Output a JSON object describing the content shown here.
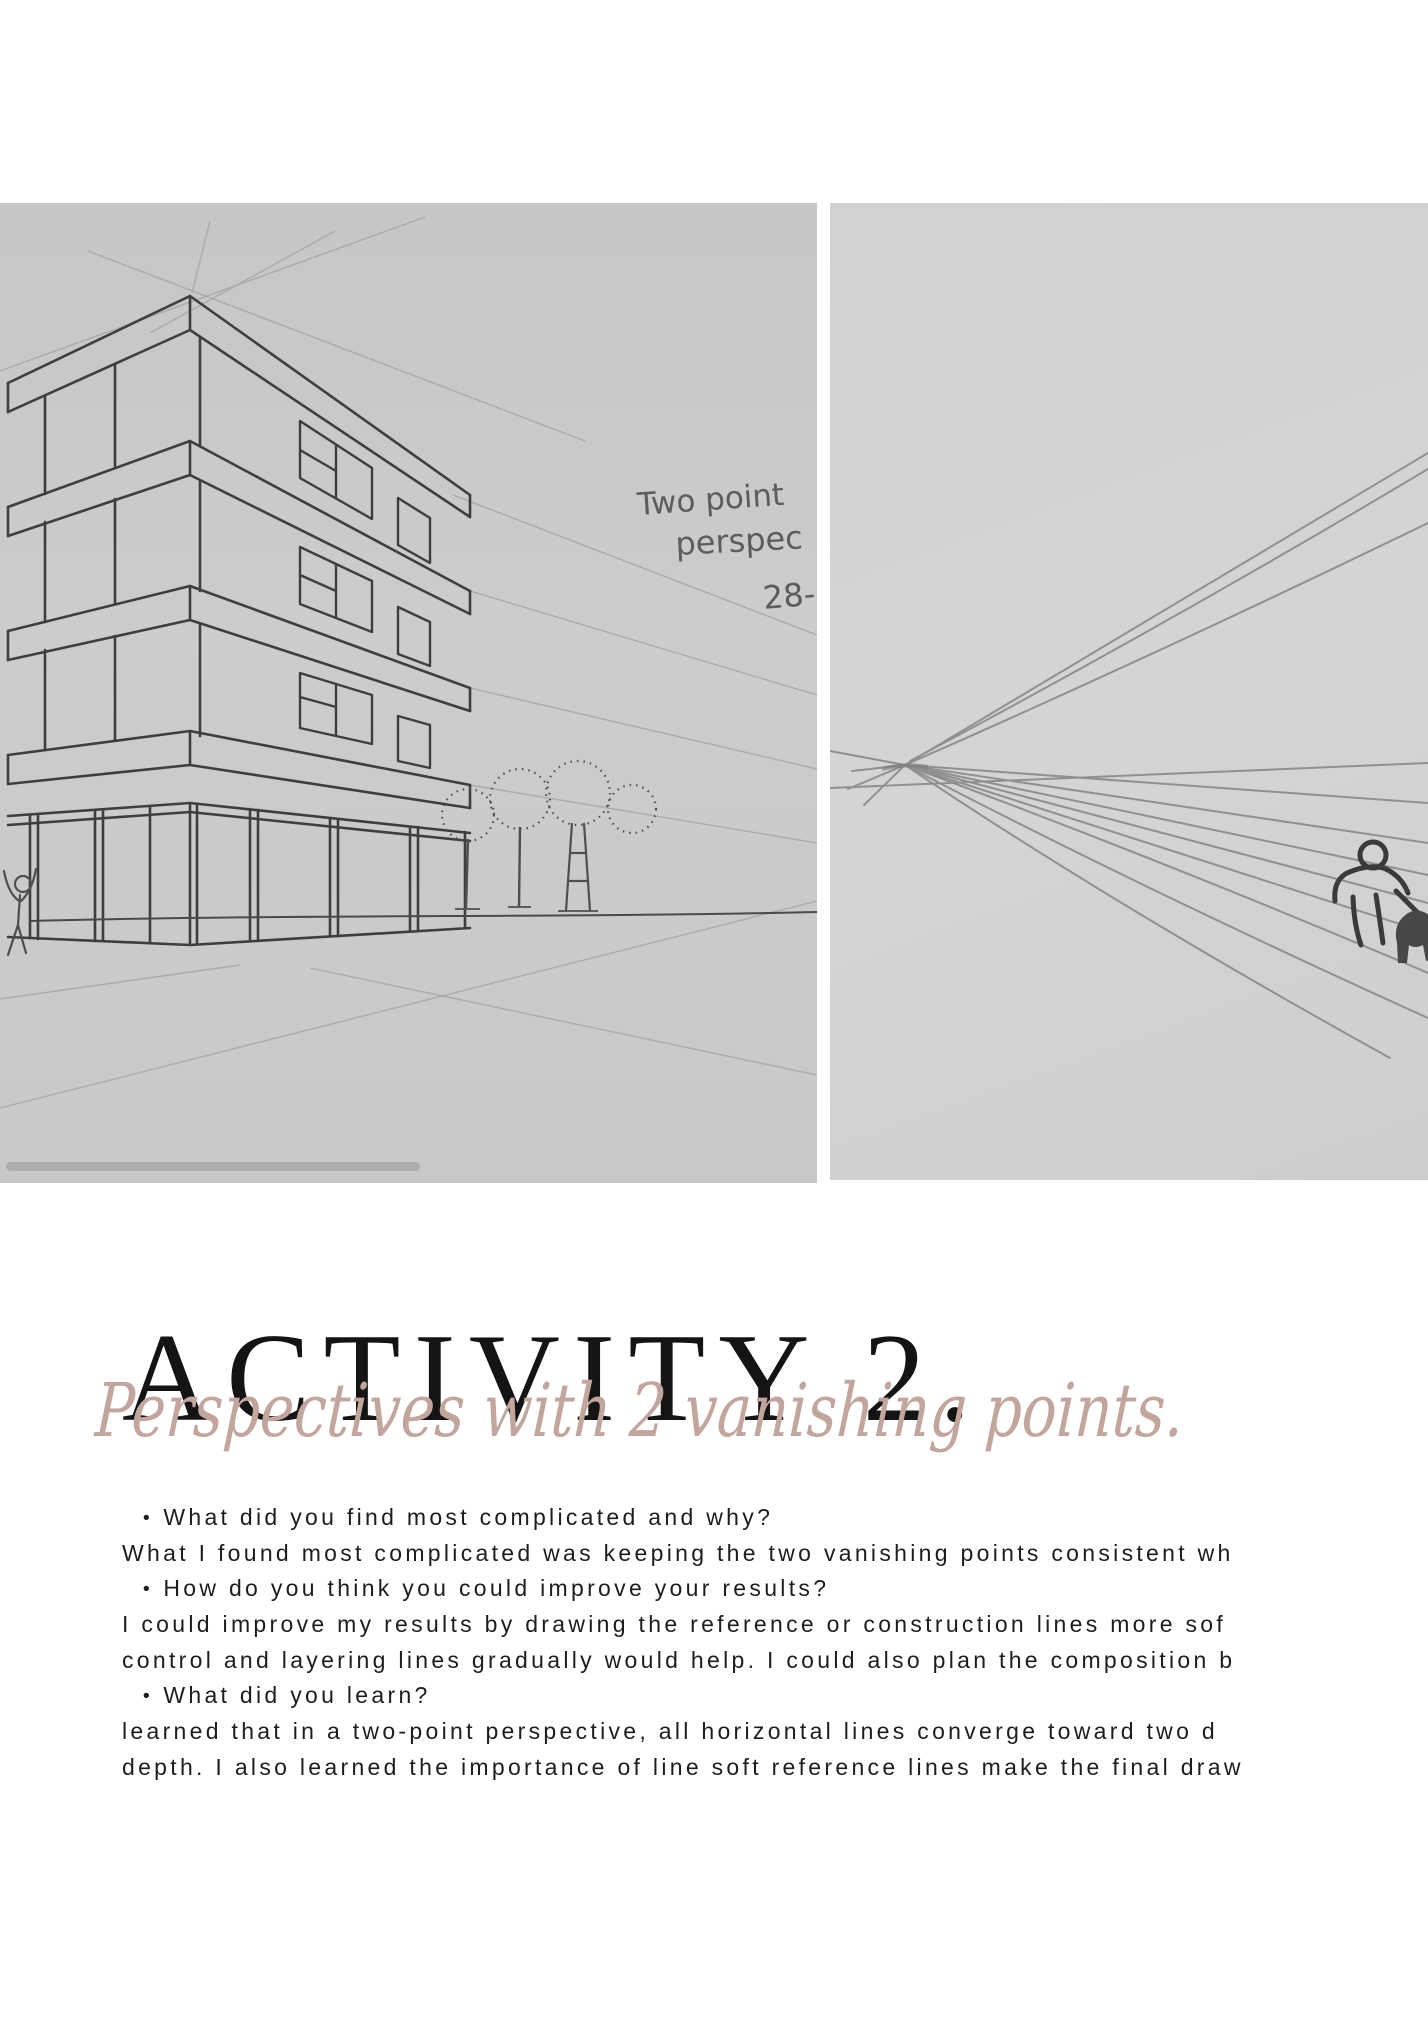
{
  "activity": {
    "title": "ACTIVITY 2.",
    "subtitle": "Perspectives with 2 vanishing points."
  },
  "sketches": {
    "left": {
      "label": "two-point perspective building sketch",
      "handwriting": {
        "line1": "Two point",
        "line2": "perspec",
        "line3": "28-"
      }
    },
    "right": {
      "label": "two-point perspective vanishing lines practice sketch"
    }
  },
  "qa": {
    "bullet": "•",
    "lines": [
      {
        "style": "question",
        "text": "What did you find most complicated and why?"
      },
      {
        "style": "answer",
        "text": "What I found most complicated was keeping the two vanishing points consistent wh"
      },
      {
        "style": "question",
        "text": "How do you think you could improve your results?"
      },
      {
        "style": "answer",
        "text": "I could improve my results by drawing the reference or construction lines more sof"
      },
      {
        "style": "answer",
        "text": "control and layering lines gradually would help. I could also plan the composition b"
      },
      {
        "style": "question",
        "text": "What did you learn?"
      },
      {
        "style": "answer",
        "text": "learned that in a two-point perspective, all horizontal lines converge toward two d"
      },
      {
        "style": "answer",
        "text": "depth. I also learned the importance of line soft reference lines make the final draw"
      }
    ]
  },
  "colors": {
    "title": "#141414",
    "subtitle": "#c2a69d",
    "body_text": "#1d1d1d",
    "sketch_paper_left": "#cac9c7",
    "sketch_paper_right": "#d2d1cf",
    "progress_bar": "#a8a8a8",
    "pen_line": "#3e3e3e",
    "pencil_line": "#a6a6a6"
  }
}
